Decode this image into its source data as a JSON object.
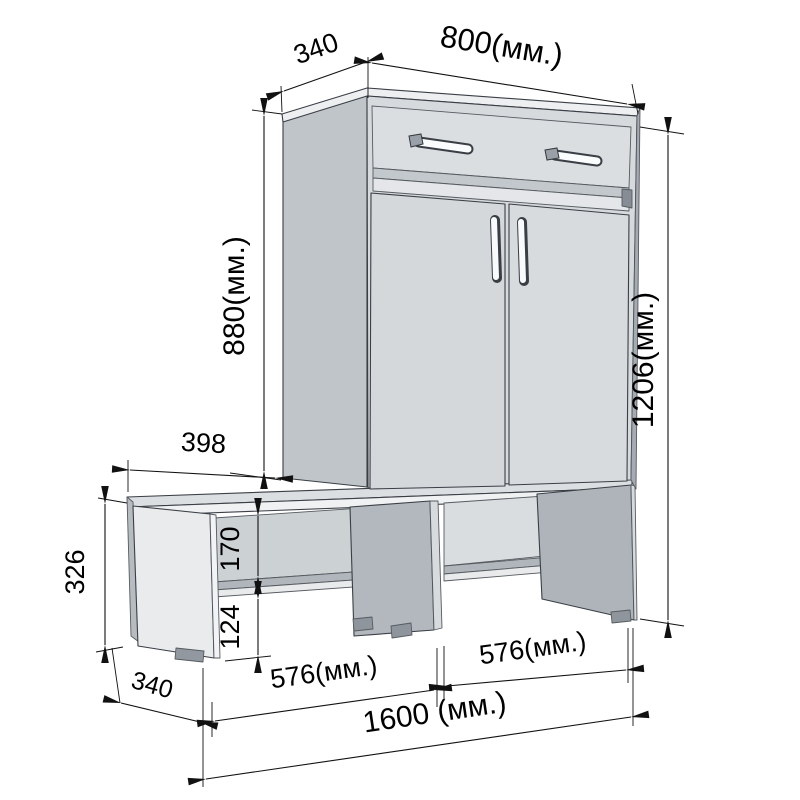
{
  "drawing": {
    "type": "furniture-dimension-drawing",
    "subject": "hallway shoe cabinet with bench",
    "units_suffix": "(мм.)",
    "dimensions": {
      "top_depth": "340",
      "cabinet_width": "800(мм.)",
      "cabinet_height": "880(мм.)",
      "total_height": "1206(мм.)",
      "bench_left_offset": "398",
      "bench_height": "326",
      "shelf_opening_height": "170",
      "under_shelf_height": "124",
      "bench_depth": "340",
      "left_compartment_width": "576(мм.)",
      "right_compartment_width": "576(мм.)",
      "total_width": "1600 (мм.)"
    },
    "colors": {
      "line": "#111111",
      "front_face": "#d6dadd",
      "side_face": "#c0c5ca",
      "interior": "#ccd1d4",
      "panel_dark": "#aeb4ba",
      "edge_light": "#f0f1f3",
      "feet": "#8f959d"
    }
  }
}
